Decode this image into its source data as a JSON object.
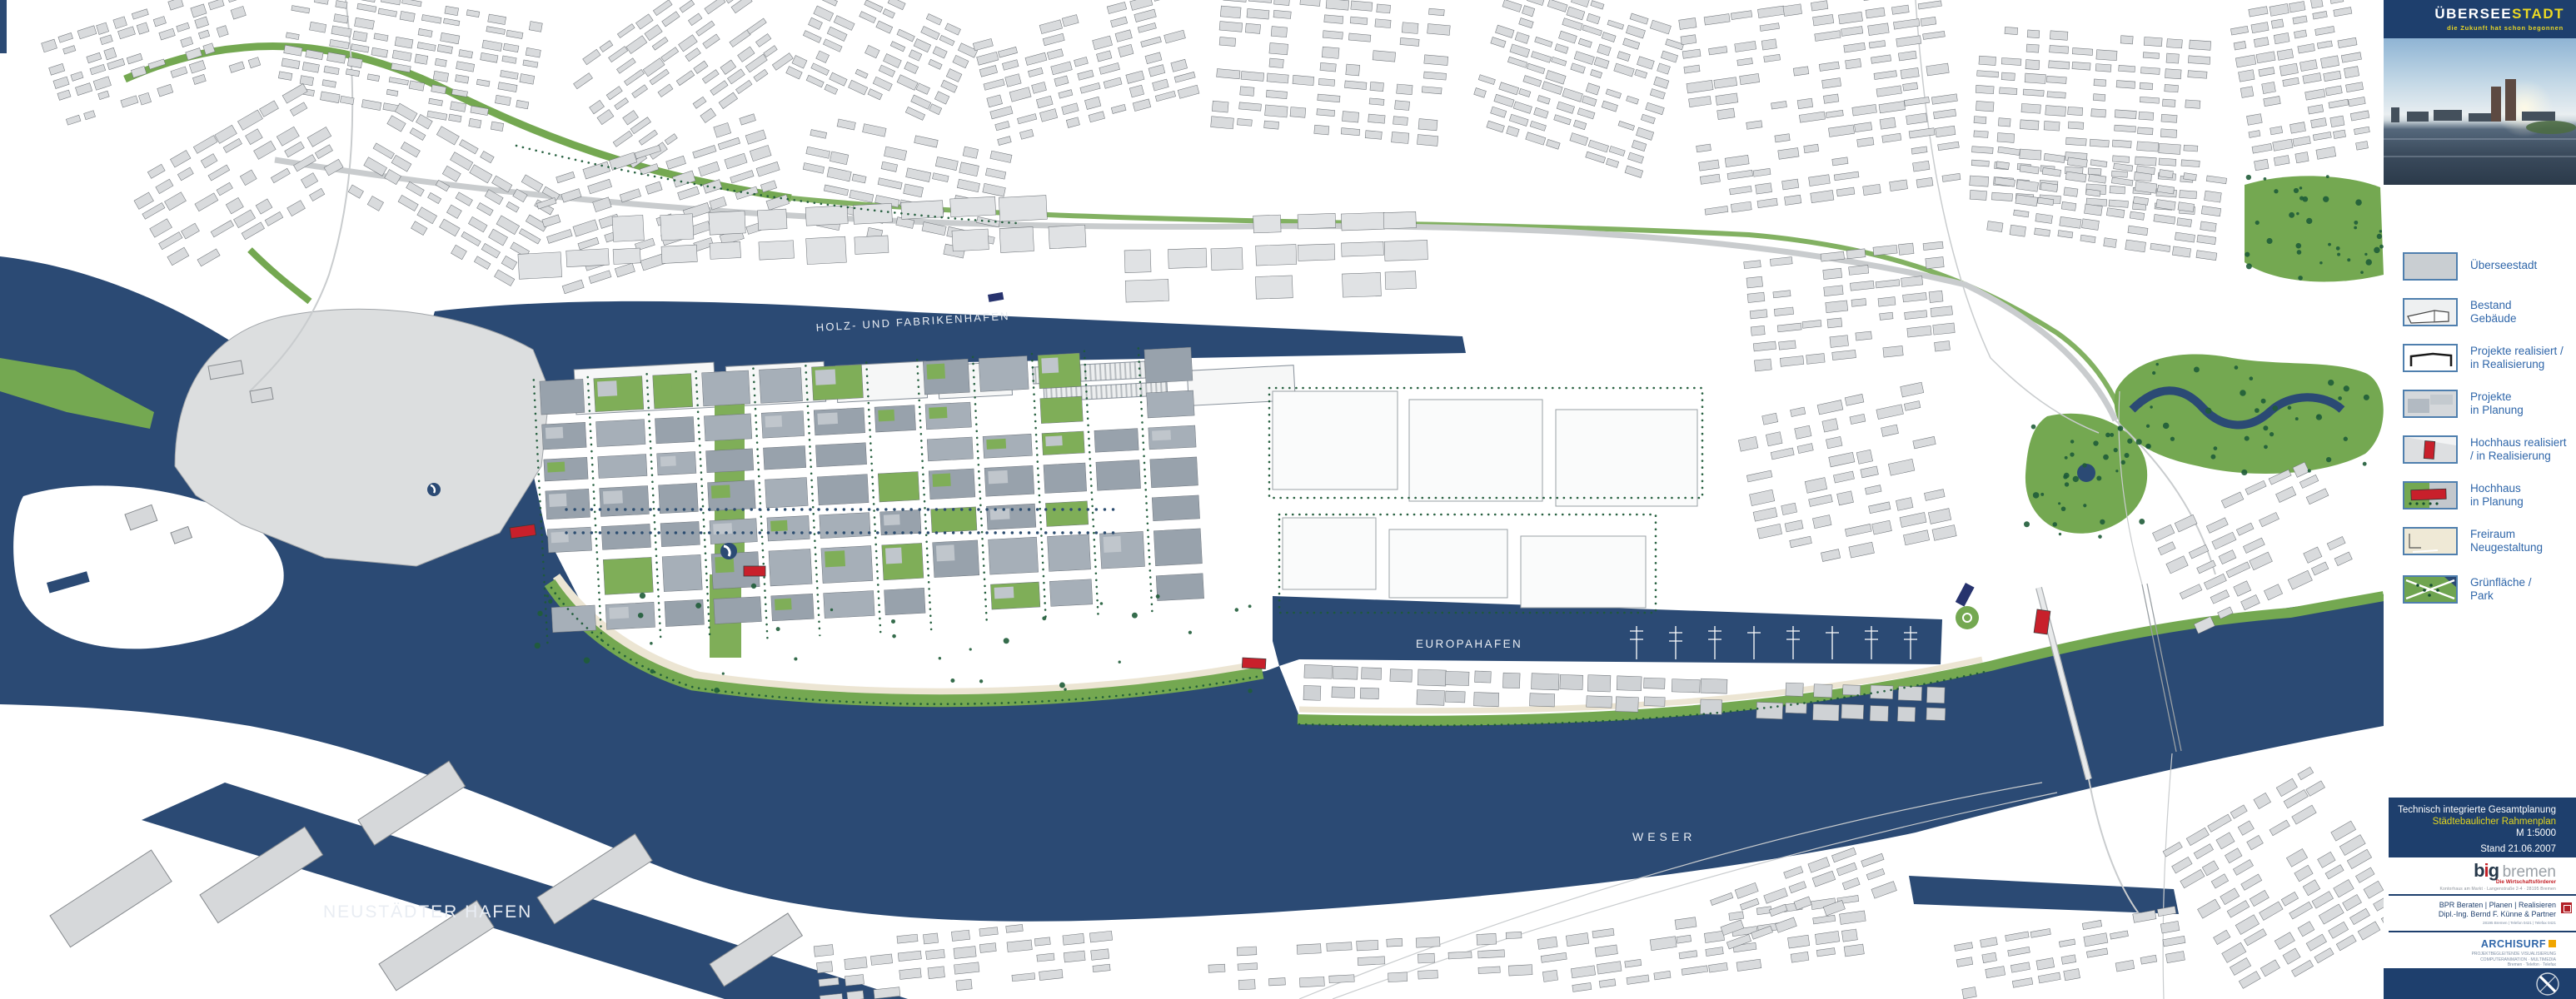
{
  "sidebar": {
    "logo": {
      "part1": "ÜBERSEE",
      "part2": "STADT",
      "tagline": "die Zukunft hat schon begonnen"
    },
    "legend": {
      "items": [
        {
          "label": "Überseestadt"
        },
        {
          "label": "Bestand\nGebäude"
        },
        {
          "label": "Projekte realisiert /\nin Realisierung"
        },
        {
          "label": "Projekte\nin Planung"
        },
        {
          "label": "Hochhaus realisiert\n/ in Realisierung"
        },
        {
          "label": "Hochhaus\nin Planung"
        },
        {
          "label": "Freiraum\nNeugestaltung"
        },
        {
          "label": "Grünfläche /\nPark"
        }
      ]
    },
    "info": {
      "line1": "Technisch integrierte Gesamtplanung",
      "line2": "Städtebaulicher Rahmenplan",
      "line3": "M 1:5000",
      "line4": "Stand 21.06.2007"
    },
    "partners": {
      "big": {
        "name_bold": "b",
        "name_i": "i",
        "name_g": "g",
        "name_rest": "bremen",
        "subtitle": "Die Wirtschaftsförderer",
        "address": "Kontorhaus am Markt · Langenstraße 2-4 · 28195 Bremen"
      },
      "bpr": {
        "line1": "BPR Beraten | Planen | Realisieren",
        "line2": "Dipl.-Ing. Bernd F. Künne & Partner",
        "line3": "28195 Bremen | Telefon 0421 | Telefax 0421"
      },
      "archisurf": {
        "name": "ARCHISURF",
        "line1": "PROJEKTBEGLEITENDE VISUALISIERUNG",
        "line2": "COMPUTERANIMATION · MULTIMEDIA",
        "line3": "Bremen · Telefon · Telefax"
      }
    }
  },
  "map": {
    "labels": {
      "holzhafen": "HOLZ- UND FABRIKENHAFEN",
      "europahafen": "EUROPAHAFEN",
      "weser": "WESER",
      "neustaedter": "NEUSTÄDTER HAFEN"
    }
  },
  "colors": {
    "water": "#2b4a74",
    "navy_panel": "#1e3f6d",
    "yellow": "#ecd923",
    "legend_blue": "#2f66a9",
    "green": "#74a851",
    "tree_green": "#1d5a38",
    "building_gray": "#d9dbdd",
    "district_gray": "#98a2ac",
    "accent_red": "#c8202b",
    "cream": "#ece5d3",
    "orange": "#f0a500"
  }
}
